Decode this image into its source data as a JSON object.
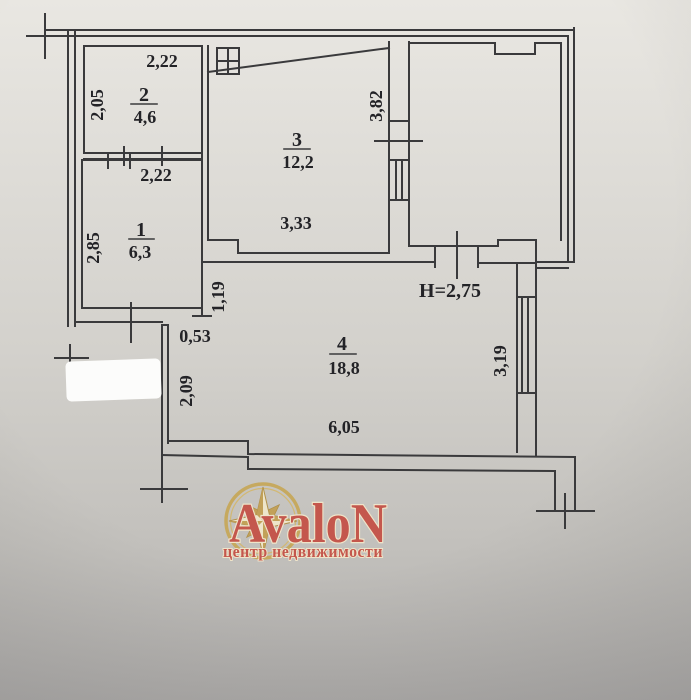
{
  "plan": {
    "ceiling_height": "H=2,75",
    "rooms": {
      "room1": {
        "number": "1",
        "area": "6,3",
        "width": "2,22",
        "depth": "2,85"
      },
      "room2": {
        "number": "2",
        "area": "4,6",
        "width": "2,22",
        "depth": "2,05"
      },
      "room3": {
        "number": "3",
        "area": "12,2",
        "width": "3,33",
        "balcony_wall": "3,82"
      },
      "room4": {
        "number": "4",
        "area": "18,8",
        "width": "6,05",
        "right_side": "3,19",
        "left_side": "2,09",
        "entry_width": "0,53",
        "partition": "1,19"
      }
    }
  },
  "watermark": {
    "brand": "AvaloN",
    "tagline": "центр недвижимости"
  },
  "colors": {
    "ink": "#3a3a3c",
    "paper_top": "#e8e6e1",
    "paper_bottom": "#b3b1ae",
    "brand_red": "#c4574d",
    "brand_gold": "#c6a95f",
    "star_cream": "#ede5ca"
  }
}
